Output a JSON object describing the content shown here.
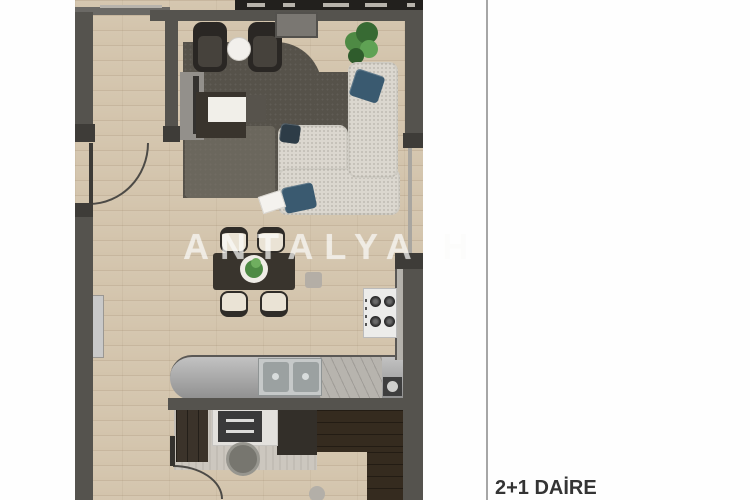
{
  "caption": {
    "text": "2+1 DAİRE"
  },
  "watermark": {
    "text": "ANTALYA H"
  },
  "palette": {
    "page_bg": "#fefefe",
    "divider_color": "#a6a6a6",
    "caption_color": "#343434",
    "watermark_color": "rgba(250,250,248,0.62)",
    "wall": "#55534e",
    "wall_dark": "#3e3c38",
    "balcony": "#22201d",
    "wood": "#d3c4ac",
    "rug": "#56524a",
    "rug_light": "#7d786e",
    "sofa": "#dbd7cf",
    "pillow": "#3a5a70",
    "pillow_dark": "#2d3c47",
    "plant": "#4e8a44",
    "plant_dark": "#2f5c2c",
    "table": "#39342d",
    "chair_seat": "#eae3d5",
    "chair_trim": "#2f2c28",
    "counter_light": "#c2c2c2",
    "counter_dark": "#8f8f8f",
    "marble": "#b7b4ae",
    "steel": "#c6c9c9",
    "stove": "#ececea",
    "burner": "#2a2a2a",
    "bedroom": "#352b1f",
    "concrete": "#ccc7bf",
    "desk": "#e3e1dd",
    "drawer": "#3a3a3a",
    "radiator": "#c9c9c9",
    "wardrobe": "#3b332a",
    "arc": "#4c4a46"
  }
}
